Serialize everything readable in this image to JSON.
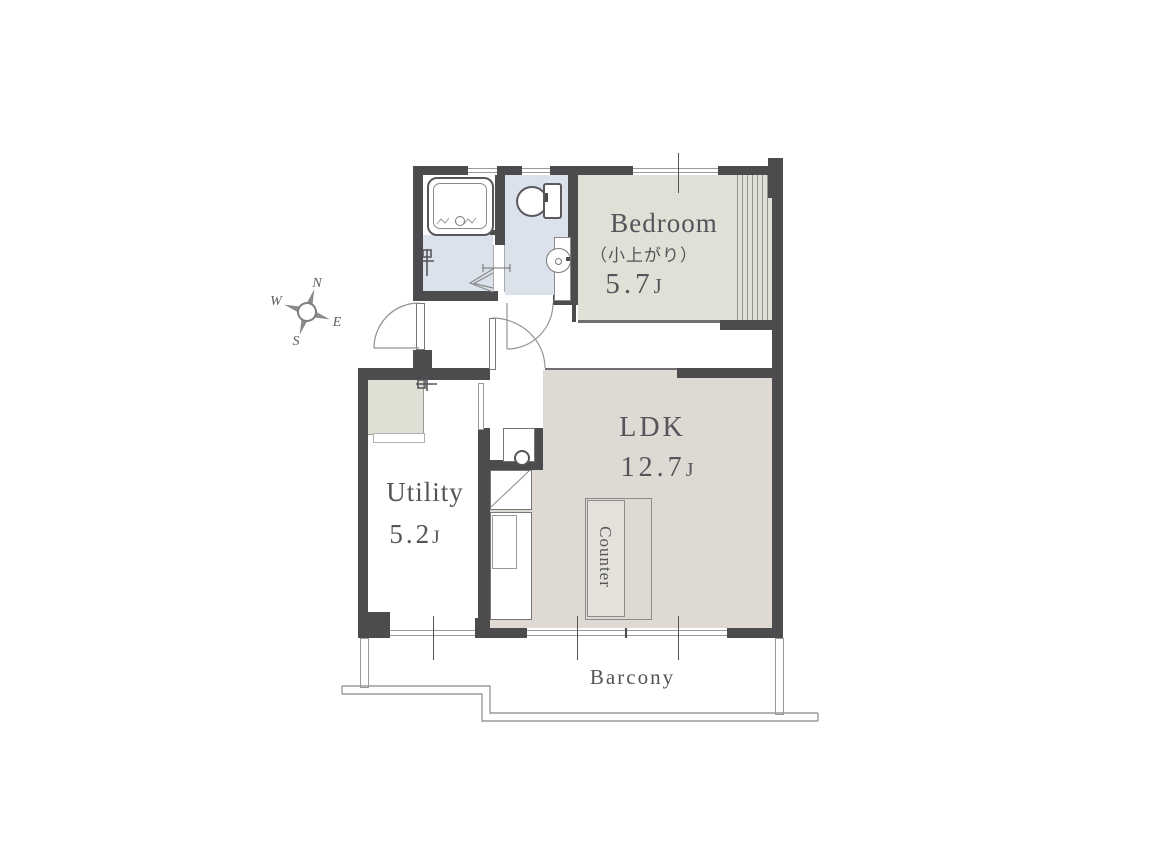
{
  "plan": {
    "compass": {
      "north": "N",
      "east": "E",
      "south": "S",
      "west": "W"
    },
    "rooms": {
      "bedroom": {
        "name": "Bedroom",
        "note": "（小上がり）",
        "area": "5.7",
        "unit": "J"
      },
      "ldk": {
        "name": "LDK",
        "area": "12.7",
        "unit": "J"
      },
      "utility": {
        "name": "Utility",
        "area": "5.2",
        "unit": "J"
      },
      "counter": {
        "name": "Counter"
      },
      "balcony": {
        "name": "Barcony"
      }
    },
    "fixtures": [
      "bathtub",
      "toilet",
      "washbasin",
      "kitchen-sink",
      "refrigerator-space",
      "kitchen-counter",
      "island-counter",
      "washing-machine-tap",
      "utility-tap",
      "closet"
    ],
    "colors": {
      "wall": "#4c4c4f",
      "bedroom_floor": "#e0e1d6",
      "ldk_floor": "#ded9d3",
      "wet_area_floor": "#dbe2eb",
      "outline": "#949494",
      "text": "#54545a"
    }
  }
}
